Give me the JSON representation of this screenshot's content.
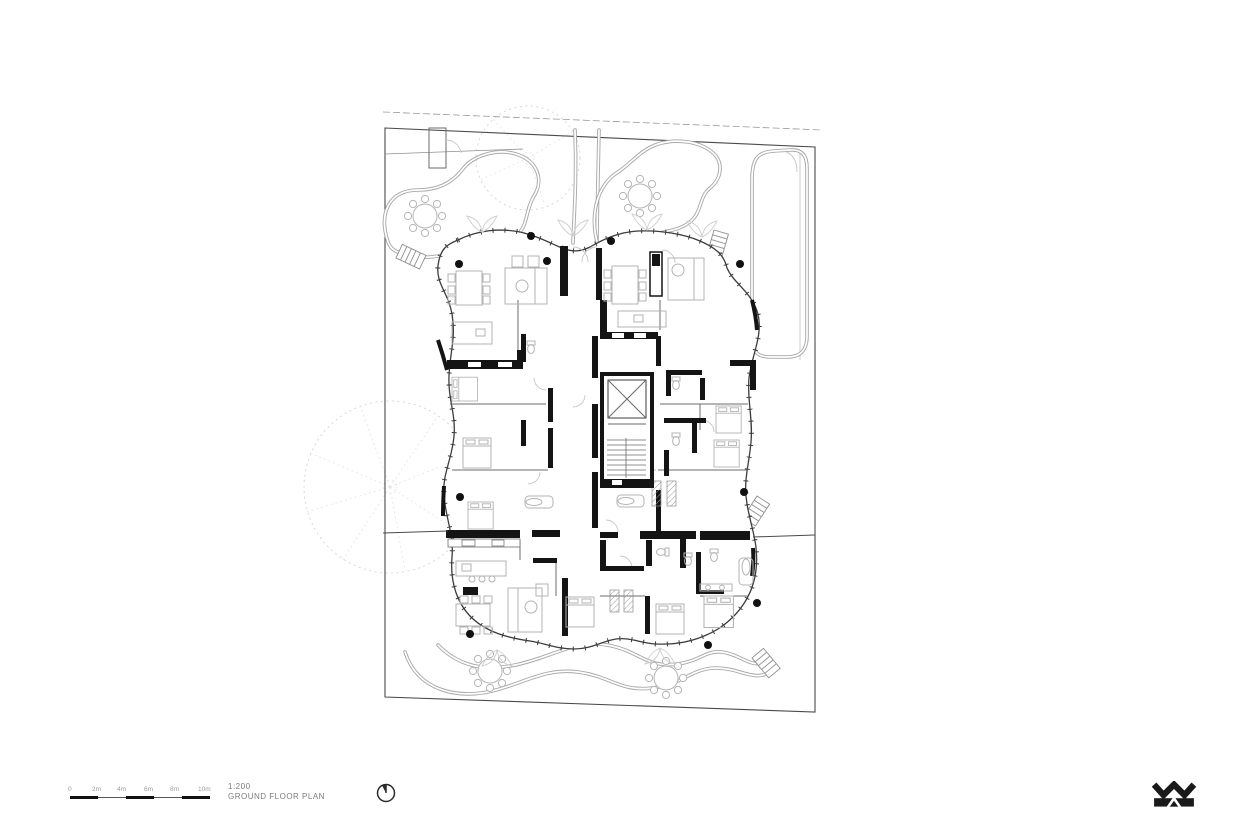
{
  "sheet": {
    "background": "#ffffff",
    "scale_text": "1:200",
    "drawing_title": "GROUND FLOOR PLAN",
    "scale_bar_labels": [
      "0",
      "2m",
      "4m",
      "6m",
      "8m",
      "10m"
    ]
  },
  "symbols": {
    "north_arrow_icon": "north-arrow",
    "logo_monogram": "WM"
  },
  "colors": {
    "linework_dark": "#3c3c3c",
    "linework_mid": "#9a9a9a",
    "linework_light": "#d6d6d6",
    "wall_poche": "#141414",
    "label_gray": "#8a8a8a"
  },
  "plan_features": [
    "site boundary",
    "ground floor building footprint with curved glazed facade",
    "central elevator core",
    "central staircase",
    "residential units with kitchens, beds, sofas, dining tables and bathrooms",
    "curved garden paths",
    "trees shown dashed",
    "outdoor round dining tables with chairs",
    "external garden stairs",
    "structural columns",
    "section match line"
  ]
}
